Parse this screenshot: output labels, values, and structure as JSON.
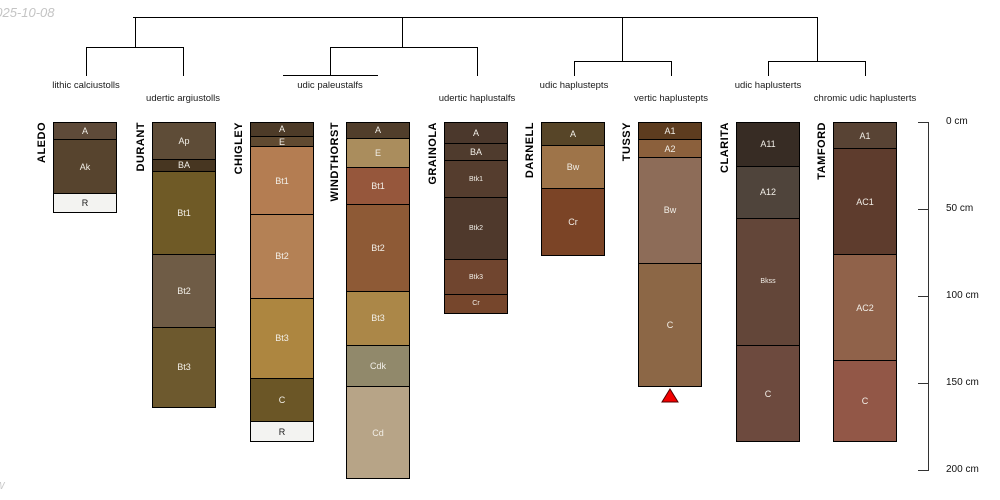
{
  "page": {
    "date_stamp": "2025-10-08",
    "corner_mark": "W"
  },
  "chart_data": {
    "type": "soil-profile-dendrogram",
    "description": "Hierarchical clustering dendrogram over 9 soil profile sketches with horizon depths",
    "depth_axis": {
      "unit": "cm",
      "min": 0,
      "max": 200,
      "ticks": [
        {
          "value": 0,
          "label": "0 cm"
        },
        {
          "value": 50,
          "label": "50 cm"
        },
        {
          "value": 100,
          "label": "100 cm"
        },
        {
          "value": 150,
          "label": "150 cm"
        },
        {
          "value": 200,
          "label": "200 cm"
        }
      ]
    },
    "dendrogram": {
      "line_color": "#000000",
      "segments": [
        {
          "x1": 133,
          "y1": 17,
          "x2": 817,
          "y2": 17
        },
        {
          "x1": 135,
          "y1": 17,
          "x2": 135,
          "y2": 47
        },
        {
          "x1": 86,
          "y1": 47,
          "x2": 183,
          "y2": 47
        },
        {
          "x1": 86,
          "y1": 47,
          "x2": 86,
          "y2": 76
        },
        {
          "x1": 183,
          "y1": 47,
          "x2": 183,
          "y2": 76
        },
        {
          "x1": 402,
          "y1": 17,
          "x2": 402,
          "y2": 47
        },
        {
          "x1": 330,
          "y1": 47,
          "x2": 477,
          "y2": 47
        },
        {
          "x1": 330,
          "y1": 47,
          "x2": 330,
          "y2": 75
        },
        {
          "x1": 283,
          "y1": 75,
          "x2": 378,
          "y2": 75
        },
        {
          "x1": 477,
          "y1": 47,
          "x2": 477,
          "y2": 76
        },
        {
          "x1": 622,
          "y1": 17,
          "x2": 622,
          "y2": 61
        },
        {
          "x1": 574,
          "y1": 61,
          "x2": 671,
          "y2": 61
        },
        {
          "x1": 574,
          "y1": 61,
          "x2": 574,
          "y2": 76
        },
        {
          "x1": 671,
          "y1": 61,
          "x2": 671,
          "y2": 76
        },
        {
          "x1": 817,
          "y1": 17,
          "x2": 817,
          "y2": 61
        },
        {
          "x1": 768,
          "y1": 61,
          "x2": 865,
          "y2": 61
        },
        {
          "x1": 768,
          "y1": 61,
          "x2": 768,
          "y2": 76
        },
        {
          "x1": 865,
          "y1": 61,
          "x2": 865,
          "y2": 76
        }
      ],
      "taxa_labels": [
        {
          "label": "lithic calciustolls",
          "x": 86,
          "row": 1
        },
        {
          "label": "udertic argiustolls",
          "x": 183,
          "row": 2
        },
        {
          "label": "udic paleustalfs",
          "x": 330,
          "row": 1
        },
        {
          "label": "udertic haplustalfs",
          "x": 477,
          "row": 2
        },
        {
          "label": "udic haplustepts",
          "x": 574,
          "row": 1
        },
        {
          "label": "vertic haplustepts",
          "x": 671,
          "row": 2
        },
        {
          "label": "udic haplusterts",
          "x": 768,
          "row": 1
        },
        {
          "label": "chromic udic haplusterts",
          "x": 865,
          "row": 2
        }
      ]
    },
    "marker": {
      "shape": "triangle-up",
      "fill": "#f20000",
      "stroke": "#550000",
      "attached_to_profile": "TUSSY"
    },
    "profiles": [
      {
        "name": "ALEDO",
        "x": 53,
        "horizons": [
          {
            "name": "A",
            "top": 0,
            "bottom": 10,
            "color": "#5e4a39"
          },
          {
            "name": "Ak",
            "top": 10,
            "bottom": 41,
            "color": "#57442e"
          },
          {
            "name": "R",
            "top": 41,
            "bottom": 51,
            "color": "#f3f3f1",
            "text": "#1a1a1a"
          }
        ]
      },
      {
        "name": "DURANT",
        "x": 152,
        "horizons": [
          {
            "name": "Ap",
            "top": 0,
            "bottom": 21,
            "color": "#5e4c37"
          },
          {
            "name": "BA",
            "top": 21,
            "bottom": 28,
            "color": "#473621"
          },
          {
            "name": "Bt1",
            "top": 28,
            "bottom": 76,
            "color": "#6f5a26"
          },
          {
            "name": "Bt2",
            "top": 76,
            "bottom": 118,
            "color": "#6f5c46"
          },
          {
            "name": "Bt3",
            "top": 118,
            "bottom": 163,
            "color": "#6d592e"
          }
        ]
      },
      {
        "name": "CHIGLEY",
        "x": 250,
        "horizons": [
          {
            "name": "A",
            "top": 0,
            "bottom": 8,
            "color": "#4d3b28"
          },
          {
            "name": "E",
            "top": 8,
            "bottom": 14,
            "color": "#604a31"
          },
          {
            "name": "Bt1",
            "top": 14,
            "bottom": 53,
            "color": "#b47d52"
          },
          {
            "name": "Bt2",
            "top": 53,
            "bottom": 101,
            "color": "#b48155"
          },
          {
            "name": "Bt3",
            "top": 101,
            "bottom": 147,
            "color": "#ad8640"
          },
          {
            "name": "C",
            "top": 147,
            "bottom": 172,
            "color": "#6b5626"
          },
          {
            "name": "R",
            "top": 172,
            "bottom": 183,
            "color": "#f3f3f1",
            "text": "#1a1a1a"
          }
        ]
      },
      {
        "name": "WINDTHORST",
        "x": 346,
        "horizons": [
          {
            "name": "A",
            "top": 0,
            "bottom": 9,
            "color": "#513e2b"
          },
          {
            "name": "E",
            "top": 9,
            "bottom": 26,
            "color": "#aa8d5d"
          },
          {
            "name": "Bt1",
            "top": 26,
            "bottom": 47,
            "color": "#96573c"
          },
          {
            "name": "Bt2",
            "top": 47,
            "bottom": 97,
            "color": "#8e5a36"
          },
          {
            "name": "Bt3",
            "top": 97,
            "bottom": 128,
            "color": "#ab8748"
          },
          {
            "name": "Cdk",
            "top": 128,
            "bottom": 152,
            "color": "#91896b"
          },
          {
            "name": "Cd",
            "top": 152,
            "bottom": 204,
            "color": "#b7a487"
          }
        ]
      },
      {
        "name": "GRAINOLA",
        "x": 444,
        "horizons": [
          {
            "name": "A",
            "top": 0,
            "bottom": 12,
            "color": "#4b382c"
          },
          {
            "name": "BA",
            "top": 12,
            "bottom": 22,
            "color": "#4f3b2d"
          },
          {
            "name": "Btk1",
            "top": 22,
            "bottom": 43,
            "color": "#553d2e",
            "small": true
          },
          {
            "name": "Btk2",
            "top": 43,
            "bottom": 79,
            "color": "#4f392c",
            "small": true
          },
          {
            "name": "Btk3",
            "top": 79,
            "bottom": 99,
            "color": "#70452f",
            "small": true
          },
          {
            "name": "Cr",
            "top": 99,
            "bottom": 109,
            "color": "#76462c",
            "small": true
          }
        ]
      },
      {
        "name": "DARNELL",
        "x": 541,
        "horizons": [
          {
            "name": "A",
            "top": 0,
            "bottom": 13,
            "color": "#574528"
          },
          {
            "name": "Bw",
            "top": 13,
            "bottom": 38,
            "color": "#9e7449"
          },
          {
            "name": "Cr",
            "top": 38,
            "bottom": 76,
            "color": "#7b4426"
          }
        ]
      },
      {
        "name": "TUSSY",
        "x": 638,
        "has_marker": true,
        "horizons": [
          {
            "name": "A1",
            "top": 0,
            "bottom": 10,
            "color": "#5d3c1f"
          },
          {
            "name": "A2",
            "top": 10,
            "bottom": 20,
            "color": "#8b603c"
          },
          {
            "name": "Bw",
            "top": 20,
            "bottom": 81,
            "color": "#8d6c58"
          },
          {
            "name": "C",
            "top": 81,
            "bottom": 151,
            "color": "#8c6746"
          }
        ]
      },
      {
        "name": "CLARITA",
        "x": 736,
        "horizons": [
          {
            "name": "A11",
            "top": 0,
            "bottom": 25,
            "color": "#372c24"
          },
          {
            "name": "A12",
            "top": 25,
            "bottom": 55,
            "color": "#4f443b"
          },
          {
            "name": "Bkss",
            "top": 55,
            "bottom": 128,
            "color": "#634639",
            "small": true
          },
          {
            "name": "C",
            "top": 128,
            "bottom": 183,
            "color": "#6d4a3e"
          }
        ]
      },
      {
        "name": "TAMFORD",
        "x": 833,
        "horizons": [
          {
            "name": "A1",
            "top": 0,
            "bottom": 15,
            "color": "#584334"
          },
          {
            "name": "AC1",
            "top": 15,
            "bottom": 76,
            "color": "#5e3c2d"
          },
          {
            "name": "AC2",
            "top": 76,
            "bottom": 137,
            "color": "#90624a"
          },
          {
            "name": "C",
            "top": 137,
            "bottom": 183,
            "color": "#925747"
          }
        ]
      }
    ]
  }
}
